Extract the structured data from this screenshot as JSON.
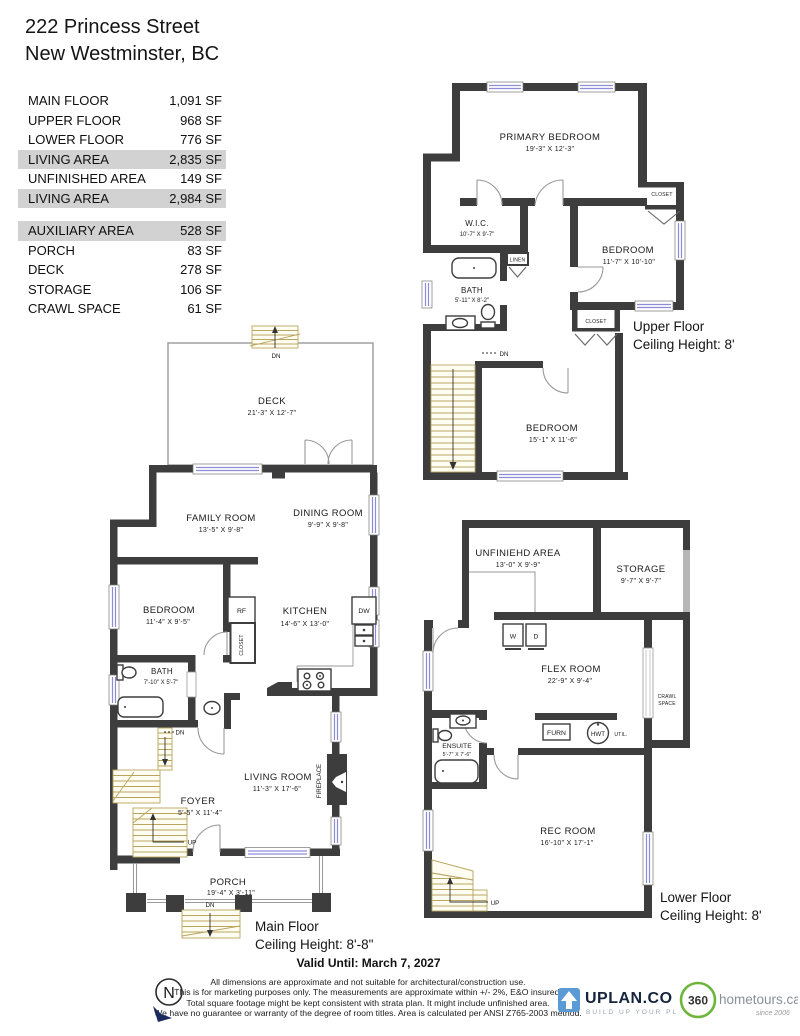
{
  "header": {
    "address_line1": "222 Princess Street",
    "address_line2": "New Westminster, BC"
  },
  "area_table": {
    "rows": [
      {
        "label": "MAIN FLOOR",
        "value": "1,091 SF",
        "highlight": false
      },
      {
        "label": "UPPER FLOOR",
        "value": "968 SF",
        "highlight": false
      },
      {
        "label": "LOWER FLOOR",
        "value": "776 SF",
        "highlight": false
      },
      {
        "label": "LIVING AREA",
        "value": "2,835 SF",
        "highlight": true
      },
      {
        "label": "UNFINISHED AREA",
        "value": "149 SF",
        "highlight": false
      },
      {
        "label": "LIVING AREA",
        "value": "2,984 SF",
        "highlight": true
      },
      {
        "label": "AUXILIARY AREA",
        "value": "528 SF",
        "highlight": true
      },
      {
        "label": "PORCH",
        "value": "83 SF",
        "highlight": false
      },
      {
        "label": "DECK",
        "value": "278 SF",
        "highlight": false
      },
      {
        "label": "STORAGE",
        "value": "106 SF",
        "highlight": false
      },
      {
        "label": "CRAWL SPACE",
        "value": "61 SF",
        "highlight": false
      }
    ]
  },
  "floors": {
    "upper": {
      "caption_line1": "Upper Floor",
      "caption_line2": "Ceiling Height: 8'",
      "rooms": {
        "primary_bedroom": {
          "name": "PRIMARY BEDROOM",
          "dims": "19'-3\" X 12'-3\""
        },
        "wic": {
          "name": "W.I.C.",
          "dims": "10'-7\" X 9'-7\""
        },
        "bath": {
          "name": "BATH",
          "dims": "5'-11\" X 8'-2\""
        },
        "bedroom2": {
          "name": "BEDROOM",
          "dims": "11'-7\" X 10'-10\""
        },
        "bedroom3": {
          "name": "BEDROOM",
          "dims": "15'-1\" X 11'-6\""
        }
      },
      "labels": {
        "closet_a": "CLOSET",
        "closet_b": "CLOSET",
        "linen": "LINEN",
        "dn": "DN"
      }
    },
    "main": {
      "caption_line1": "Main Floor",
      "caption_line2": "Ceiling Height: 8'-8\"",
      "rooms": {
        "deck": {
          "name": "DECK",
          "dims": "21'-3\" X 12'-7\""
        },
        "family_room": {
          "name": "FAMILY ROOM",
          "dims": "13'-5\" X 9'-8\""
        },
        "dining_room": {
          "name": "DINING ROOM",
          "dims": "9'-9\" X 9'-8\""
        },
        "bedroom": {
          "name": "BEDROOM",
          "dims": "11'-4\" X 9'-5\""
        },
        "kitchen": {
          "name": "KITCHEN",
          "dims": "14'-6\" X 13'-0\""
        },
        "bath": {
          "name": "BATH",
          "dims": "7'-10\" X 5'-7\""
        },
        "living_room": {
          "name": "LIVING ROOM",
          "dims": "11'-3\" X 17'-6\""
        },
        "foyer": {
          "name": "FOYER",
          "dims": "5'-5\" X 11'-4\""
        },
        "porch": {
          "name": "PORCH",
          "dims": "19'-4\" X 3'-11\""
        }
      },
      "labels": {
        "rf": "RF",
        "dw": "DW",
        "closet": "CLOSET",
        "fireplace": "FIREPLACE",
        "dn_deck": "DN",
        "dn_stairs": "DN",
        "up": "UP",
        "dn_porch": "DN"
      }
    },
    "lower": {
      "caption_line1": "Lower Floor",
      "caption_line2": "Ceiling Height: 8'",
      "rooms": {
        "unfinished_area": {
          "name": "UNFINIEHD AREA",
          "dims": "13'-0\" X 9'-9\""
        },
        "storage": {
          "name": "STORAGE",
          "dims": "9'-7\" X 9'-7\""
        },
        "flex_room": {
          "name": "FLEX ROOM",
          "dims": "22'-9\" X 9'-4\""
        },
        "ensuite": {
          "name": "ENSUITE",
          "dims": "5'-7\" X 7'-6\""
        },
        "rec_room": {
          "name": "REC ROOM",
          "dims": "16'-10\" X 17'-1\""
        }
      },
      "labels": {
        "w": "W",
        "d": "D",
        "crawl_line1": "CRAWL",
        "crawl_line2": "SPACE",
        "furn": "FURN",
        "hwt": "HWT",
        "util": "UTIL.",
        "up": "UP"
      }
    }
  },
  "footer": {
    "valid_until": "Valid Until: March 7, 2027",
    "disclaimer": [
      "All dimensions are approximate and not suitable for architectural/construction use.",
      "This is for marketing purposes only. The measurements are approximate within +/- 2%, E&O insured.",
      "Total square footage might be kept consistent with strata plan. It might include unfinished area.",
      "We have no guarantee or warranty of the degree of room titles. Area is calculated per ANSI Z765-2003 method."
    ],
    "north_letter": "N",
    "uplan_logo": {
      "name": "UPLAN.CO",
      "tagline": "BUILD UP YOUR PLAN"
    },
    "hometours_logo": {
      "number": "360",
      "domain": "hometours.ca",
      "since": "since 2006"
    }
  },
  "colors": {
    "wall": "#3d3d3d",
    "light_wall": "#b6b6b6",
    "window_blue": "#8c8cd9",
    "stair_tan": "#b8a55e",
    "table_highlight": "#d2d2d2",
    "uplan_navy": "#16243e",
    "uplan_blue": "#5b9bd5",
    "hometours_green": "#6fb53b"
  }
}
